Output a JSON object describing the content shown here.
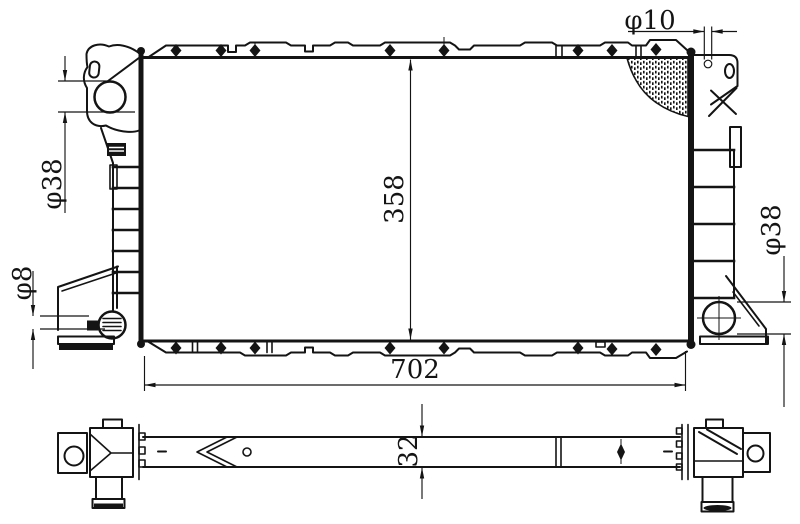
{
  "document": {
    "type": "technical drawing",
    "subject": "automotive radiator, front view and plan view",
    "background": "#ffffff",
    "line_color": "#141414"
  },
  "front_view": {
    "dim_top_hole": "φ10",
    "dim_inlet_left": "φ38",
    "dim_drain_bottom_left": "φ8",
    "dim_core_height": "358",
    "dim_overall_width": "702",
    "dim_outlet_right": "φ38"
  },
  "plan_view": {
    "dim_thickness": "32"
  }
}
